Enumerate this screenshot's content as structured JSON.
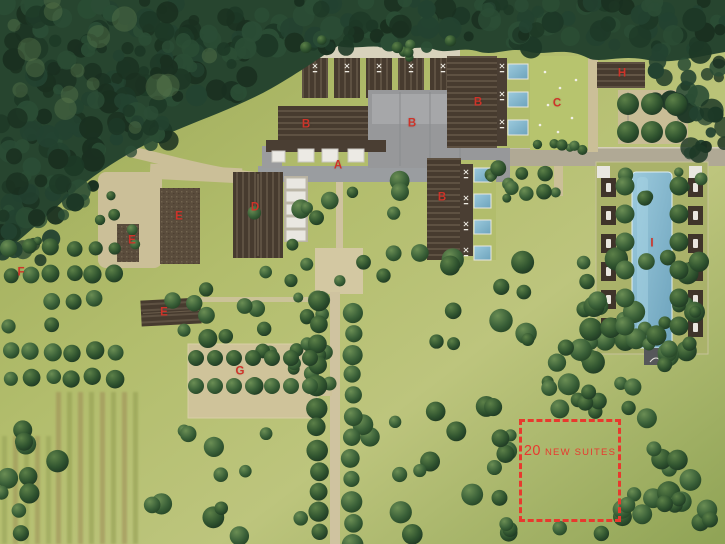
{
  "map": {
    "markers": [
      {
        "label": "A"
      },
      {
        "label": "B"
      },
      {
        "label": "B"
      },
      {
        "label": "B"
      },
      {
        "label": "B"
      },
      {
        "label": "C"
      },
      {
        "label": "D"
      },
      {
        "label": "E"
      },
      {
        "label": "E"
      },
      {
        "label": "E"
      },
      {
        "label": "F"
      },
      {
        "label": "G"
      },
      {
        "label": "H"
      },
      {
        "label": "I"
      }
    ],
    "annotation": {
      "number": "20",
      "label": "NEW SUITES"
    },
    "colors": {
      "label_red": "#ce3329",
      "dashed_box_red": "#e8392e",
      "pool_blue": "#85bcd2",
      "forest_green": "#27452f",
      "meadow_green": "#aab762",
      "road_tan": "#cbbf98",
      "road_gray": "#9a9da0",
      "roof_brown": "#473b2f",
      "roof_gray": "#97989a"
    }
  }
}
